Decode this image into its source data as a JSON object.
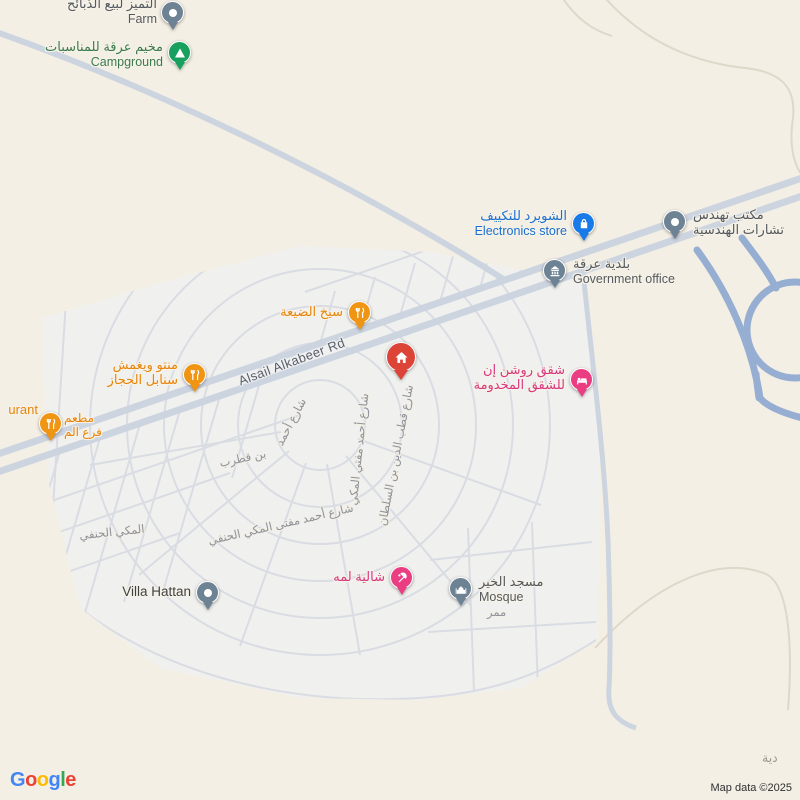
{
  "colors": {
    "background": "#f4efe4",
    "district_fill": "#f0f0ee",
    "minor_street": "#d9dce3",
    "main_road": "#ccd4e0",
    "highway_ramp": "#96aed2",
    "poi_gray": "#6d8293",
    "poi_green": "#17a05e",
    "poi_blue": "#1879e8",
    "poi_orange": "#f09413",
    "poi_pink": "#ea3d82",
    "poi_red": "#dc4437"
  },
  "pois": {
    "farm": {
      "name": "التميز لبيع الذبائح",
      "category": "Farm"
    },
    "campground": {
      "name": "مخيم عرقة للمناسبات",
      "category": "Campground"
    },
    "electronics": {
      "name": "الشويرد للتكييف",
      "category": "Electronics store"
    },
    "engineering": {
      "line1": "مكتب تهندس",
      "line2": "تشارات الهندسية"
    },
    "government": {
      "name": "بلدية عرقة",
      "category": "Government office"
    },
    "grill": {
      "name": "سيخ الضيعة"
    },
    "manto": {
      "line1": "منتو ويغمش",
      "line2": "سنابل الحجاز"
    },
    "restaurant": {
      "partial_en": "urant",
      "line1": "مطعم",
      "line2": "فرع الم"
    },
    "apartments": {
      "line1": "شقق روشن إن",
      "line2": "للشقق المخدومة"
    },
    "chalet": {
      "name": "شالية لمه"
    },
    "mosque": {
      "name": "مسجد الخير",
      "category": "Mosque"
    },
    "villa": {
      "name": "Villa Hattan"
    }
  },
  "streets": {
    "alsail": "Alsail Alkabeer Rd",
    "ahmad_mufti_vertical": "شارع أحمد مفتي المكي",
    "qutb_aldin": "شارع قطب الدين بن السلطان",
    "ahmad_mufti_curved": "شارع أحمد مفتى المكي الحنفي",
    "curved_left_fragment": "المكي الحنفي",
    "ibn_qutrub_a": "شارع أحمد",
    "ibn_qutrub_b": "بن قطرب",
    "mamarr": "ممر",
    "district_partial": "دية"
  },
  "footer": {
    "logo_letters": [
      "G",
      "o",
      "o",
      "g",
      "l",
      "e"
    ],
    "attribution": "Map data ©2025"
  }
}
